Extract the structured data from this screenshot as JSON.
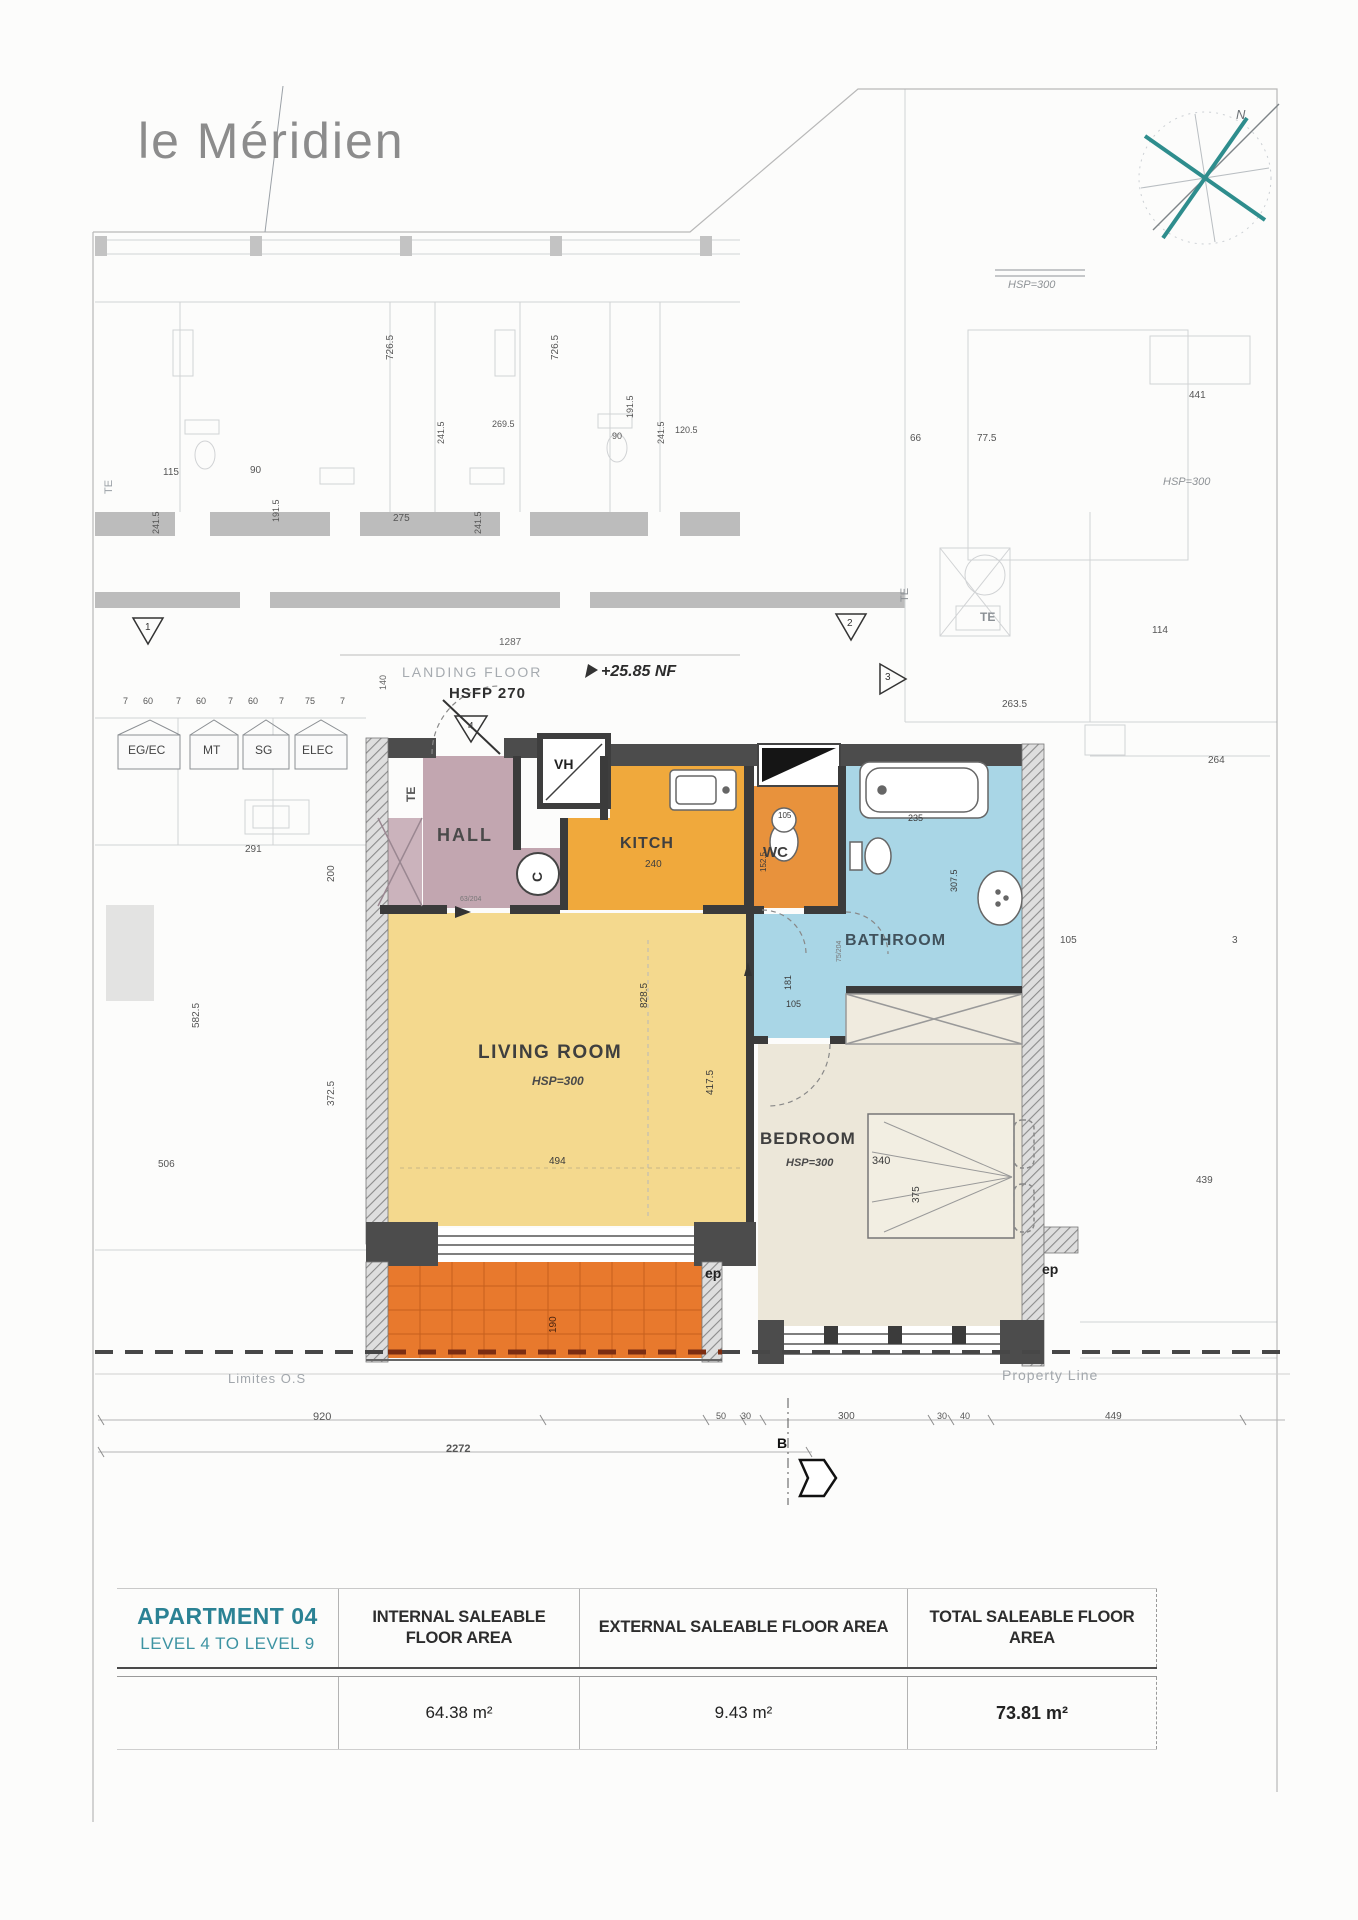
{
  "page": {
    "logo": "le Méridien"
  },
  "colors": {
    "accent_teal": "#2b8294",
    "hall": "#c2a6b0",
    "kitchen": "#f0a93c",
    "wc": "#e8923c",
    "bathroom": "#a9d6e6",
    "living_room": "#f4d98e",
    "bedroom": "#ece7d9",
    "terrace": "#e8792d",
    "wall_dark": "#4c4c4c",
    "dash_red": "#7c2d12"
  },
  "table": {
    "col1_title": "APARTMENT 04",
    "col1_subtitle": "LEVEL 4 TO LEVEL 9",
    "headers": [
      "INTERNAL SALEABLE FLOOR AREA",
      "EXTERNAL SALEABLE FLOOR AREA",
      "TOTAL SALEABLE FLOOR AREA"
    ],
    "values": [
      "64.38 m²",
      "9.43 m²",
      "73.81 m²"
    ]
  },
  "plan": {
    "labels": [
      {
        "text": "HALL",
        "x": 437,
        "y": 826,
        "size": 18,
        "weight": 700,
        "color": "#4a4a4a",
        "ls": 2,
        "name": "room-label-hall"
      },
      {
        "text": "KITCH",
        "x": 620,
        "y": 836,
        "size": 16,
        "weight": 700,
        "color": "#3f3f3f",
        "ls": 1,
        "name": "room-label-kitchen"
      },
      {
        "text": "240",
        "x": 645,
        "y": 860,
        "size": 10,
        "color": "#3f3f3f",
        "name": "dim-label"
      },
      {
        "text": "WC",
        "x": 763,
        "y": 845,
        "size": 15,
        "weight": 700,
        "color": "#3f3f3f",
        "name": "room-label-wc"
      },
      {
        "text": "BATHROOM",
        "x": 845,
        "y": 933,
        "size": 16,
        "weight": 700,
        "color": "#41525c",
        "ls": 1,
        "name": "room-label-bathroom"
      },
      {
        "text": "LIVING ROOM",
        "x": 478,
        "y": 1043,
        "size": 19,
        "weight": 700,
        "color": "#3f3f3f",
        "ls": 1.5,
        "name": "room-label-living-room"
      },
      {
        "text": "HSP=300",
        "x": 532,
        "y": 1075,
        "size": 12,
        "style": "italic",
        "weight": 600,
        "color": "#4a4a4a",
        "name": "ceiling-height-label"
      },
      {
        "text": "BEDROOM",
        "x": 760,
        "y": 1130,
        "size": 17,
        "weight": 700,
        "color": "#3f3f3f",
        "ls": 1,
        "name": "room-label-bedroom"
      },
      {
        "text": "HSP=300",
        "x": 786,
        "y": 1158,
        "size": 11,
        "style": "italic",
        "weight": 600,
        "color": "#4a4a4a",
        "name": "ceiling-height-label"
      },
      {
        "text": "VH",
        "x": 554,
        "y": 757,
        "size": 14,
        "weight": 700,
        "color": "#222",
        "name": "vh-shaft-label"
      },
      {
        "text": "C",
        "x": 530,
        "y": 882,
        "rot": -90,
        "size": 14,
        "weight": 600,
        "color": "#333",
        "name": "column-label"
      },
      {
        "text": "ep",
        "x": 705,
        "y": 1266,
        "size": 14,
        "weight": 700,
        "color": "#222",
        "name": "ep-label"
      },
      {
        "text": "ep",
        "x": 1042,
        "y": 1262,
        "size": 14,
        "weight": 700,
        "color": "#222",
        "name": "ep-label"
      },
      {
        "text": "828.5",
        "x": 640,
        "y": 1008,
        "rot": -90,
        "size": 10,
        "color": "#3a3a3a",
        "name": "dim-label"
      },
      {
        "text": "417.5",
        "x": 706,
        "y": 1095,
        "rot": -90,
        "size": 10,
        "color": "#3a3a3a",
        "name": "dim-label"
      },
      {
        "text": "494",
        "x": 549,
        "y": 1157,
        "size": 10,
        "color": "#3a3a3a",
        "name": "dim-label"
      },
      {
        "text": "152.5",
        "x": 760,
        "y": 872,
        "rot": -90,
        "size": 8,
        "color": "#3a3a3a",
        "name": "dim-label"
      },
      {
        "text": "105",
        "x": 778,
        "y": 812,
        "size": 8,
        "color": "#3a3a3a",
        "name": "dim-label"
      },
      {
        "text": "235",
        "x": 908,
        "y": 814,
        "size": 9,
        "color": "#3a3a3a",
        "name": "dim-label"
      },
      {
        "text": "307.5",
        "x": 950,
        "y": 892,
        "rot": -90,
        "size": 9,
        "color": "#3a3a3a",
        "name": "dim-label"
      },
      {
        "text": "181",
        "x": 784,
        "y": 990,
        "rot": -90,
        "size": 9,
        "color": "#3a3a3a",
        "name": "dim-label"
      },
      {
        "text": "105",
        "x": 786,
        "y": 1000,
        "size": 9,
        "color": "#3a3a3a",
        "name": "dim-label"
      },
      {
        "text": "340",
        "x": 872,
        "y": 1156,
        "size": 11,
        "color": "#3a3a3a",
        "name": "dim-label"
      },
      {
        "text": "375",
        "x": 912,
        "y": 1203,
        "rot": -90,
        "size": 10,
        "color": "#3a3a3a",
        "name": "dim-label"
      },
      {
        "text": "190",
        "x": 549,
        "y": 1333,
        "rot": -90,
        "size": 10,
        "color": "#4a2410",
        "name": "dim-label"
      },
      {
        "text": "63/204",
        "x": 460,
        "y": 896,
        "size": 7,
        "color": "#777",
        "name": "dim-label"
      },
      {
        "text": "75/204",
        "x": 836,
        "y": 962,
        "rot": -90,
        "size": 7,
        "color": "#777",
        "name": "dim-label"
      },
      {
        "text": "LANDING FLOOR",
        "x": 402,
        "y": 665,
        "size": 14,
        "color": "#a6abb0",
        "ls": 2,
        "name": "landing-floor-label"
      },
      {
        "text": "HSFP 270",
        "x": 449,
        "y": 686,
        "size": 15,
        "weight": 700,
        "color": "#2f2f2f",
        "ls": 1,
        "name": "hsfp-label"
      },
      {
        "text": "+25.85 NF",
        "x": 601,
        "y": 664,
        "size": 16,
        "weight": 700,
        "style": "italic",
        "color": "#2b2b2b",
        "name": "level-label"
      },
      {
        "text": "1287",
        "x": 499,
        "y": 638,
        "size": 10,
        "color": "#666",
        "name": "dim-label"
      },
      {
        "text": "140",
        "x": 379,
        "y": 690,
        "rot": -90,
        "size": 9,
        "color": "#666",
        "name": "dim-label"
      },
      {
        "text": "7",
        "x": 123,
        "y": 697,
        "size": 9,
        "color": "#555",
        "name": "dim-label"
      },
      {
        "text": "60",
        "x": 143,
        "y": 697,
        "size": 9,
        "color": "#555",
        "name": "dim-label"
      },
      {
        "text": "7",
        "x": 176,
        "y": 697,
        "size": 9,
        "color": "#555",
        "name": "dim-label"
      },
      {
        "text": "60",
        "x": 196,
        "y": 697,
        "size": 9,
        "color": "#555",
        "name": "dim-label"
      },
      {
        "text": "7",
        "x": 228,
        "y": 697,
        "size": 9,
        "color": "#555",
        "name": "dim-label"
      },
      {
        "text": "60",
        "x": 248,
        "y": 697,
        "size": 9,
        "color": "#555",
        "name": "dim-label"
      },
      {
        "text": "7",
        "x": 279,
        "y": 697,
        "size": 9,
        "color": "#555",
        "name": "dim-label"
      },
      {
        "text": "75",
        "x": 305,
        "y": 697,
        "size": 9,
        "color": "#555",
        "name": "dim-label"
      },
      {
        "text": "7",
        "x": 340,
        "y": 697,
        "size": 9,
        "color": "#555",
        "name": "dim-label"
      },
      {
        "text": "EG/EC",
        "x": 128,
        "y": 744,
        "size": 12,
        "color": "#444",
        "name": "utility-label-egec"
      },
      {
        "text": "MT",
        "x": 203,
        "y": 744,
        "size": 12,
        "color": "#444",
        "name": "utility-label-mt"
      },
      {
        "text": "SG",
        "x": 255,
        "y": 744,
        "size": 12,
        "color": "#444",
        "name": "utility-label-sg"
      },
      {
        "text": "ELEC",
        "x": 302,
        "y": 744,
        "size": 12,
        "color": "#444",
        "name": "utility-label-elec"
      },
      {
        "text": "1",
        "x": 145,
        "y": 623,
        "size": 10,
        "color": "#333",
        "name": "section-marker-1"
      },
      {
        "text": "2",
        "x": 847,
        "y": 619,
        "size": 10,
        "color": "#333",
        "name": "section-marker-2"
      },
      {
        "text": "3",
        "x": 885,
        "y": 673,
        "size": 10,
        "color": "#333",
        "name": "section-marker-3"
      },
      {
        "text": "4",
        "x": 468,
        "y": 722,
        "size": 10,
        "color": "#333",
        "name": "section-marker-4"
      },
      {
        "text": "B",
        "x": 777,
        "y": 1436,
        "size": 14,
        "weight": 700,
        "color": "#111",
        "name": "section-marker-b"
      },
      {
        "text": "TE",
        "x": 405,
        "y": 802,
        "rot": -90,
        "size": 12,
        "weight": 700,
        "color": "#555",
        "name": "te-label"
      },
      {
        "text": "TE",
        "x": 980,
        "y": 611,
        "size": 12,
        "weight": 700,
        "color": "#8a8f94",
        "name": "te-label"
      },
      {
        "text": "TE",
        "x": 900,
        "y": 602,
        "rot": -90,
        "size": 11,
        "color": "#8a8f94",
        "name": "te-label"
      },
      {
        "text": "TE",
        "x": 104,
        "y": 494,
        "rot": -90,
        "size": 11,
        "color": "#9aa0a6",
        "name": "te-label"
      },
      {
        "text": "726.5",
        "x": 386,
        "y": 360,
        "rot": -90,
        "size": 10,
        "name": "dim-label"
      },
      {
        "text": "726.5",
        "x": 551,
        "y": 360,
        "rot": -90,
        "size": 10,
        "name": "dim-label"
      },
      {
        "text": "115",
        "x": 163,
        "y": 468,
        "size": 10,
        "name": "dim-label"
      },
      {
        "text": "90",
        "x": 250,
        "y": 466,
        "size": 10,
        "name": "dim-label"
      },
      {
        "text": "191.5",
        "x": 272,
        "y": 522,
        "rot": -90,
        "size": 9,
        "name": "dim-label"
      },
      {
        "text": "241.5",
        "x": 152,
        "y": 534,
        "rot": -90,
        "size": 9,
        "name": "dim-label"
      },
      {
        "text": "241.5",
        "x": 474,
        "y": 534,
        "rot": -90,
        "size": 9,
        "name": "dim-label"
      },
      {
        "text": "275",
        "x": 393,
        "y": 514,
        "size": 10,
        "name": "dim-label"
      },
      {
        "text": "241.5",
        "x": 437,
        "y": 444,
        "rot": -90,
        "size": 9,
        "name": "dim-label"
      },
      {
        "text": "269.5",
        "x": 492,
        "y": 420,
        "size": 9,
        "name": "dim-label"
      },
      {
        "text": "191.5",
        "x": 626,
        "y": 418,
        "rot": -90,
        "size": 9,
        "name": "dim-label"
      },
      {
        "text": "90",
        "x": 612,
        "y": 432,
        "size": 9,
        "name": "dim-label"
      },
      {
        "text": "241.5",
        "x": 657,
        "y": 444,
        "rot": -90,
        "size": 9,
        "name": "dim-label"
      },
      {
        "text": "120.5",
        "x": 675,
        "y": 426,
        "size": 9,
        "name": "dim-label"
      },
      {
        "text": "66",
        "x": 910,
        "y": 434,
        "size": 10,
        "name": "dim-label"
      },
      {
        "text": "77.5",
        "x": 977,
        "y": 434,
        "size": 10,
        "name": "dim-label"
      },
      {
        "text": "441",
        "x": 1189,
        "y": 391,
        "size": 10,
        "name": "dim-label"
      },
      {
        "text": "HSP=300",
        "x": 1008,
        "y": 280,
        "size": 11,
        "style": "italic",
        "color": "#8e9296",
        "name": "ceiling-height-label"
      },
      {
        "text": "HSP=300",
        "x": 1163,
        "y": 477,
        "size": 11,
        "style": "italic",
        "color": "#8e9296",
        "name": "ceiling-height-label"
      },
      {
        "text": "114",
        "x": 1152,
        "y": 626,
        "size": 10,
        "name": "dim-label"
      },
      {
        "text": "263.5",
        "x": 1002,
        "y": 700,
        "size": 10,
        "name": "dim-label"
      },
      {
        "text": "264",
        "x": 1208,
        "y": 756,
        "size": 10,
        "name": "dim-label"
      },
      {
        "text": "105",
        "x": 1060,
        "y": 936,
        "size": 10,
        "name": "dim-label"
      },
      {
        "text": "3",
        "x": 1232,
        "y": 936,
        "size": 10,
        "name": "dim-label"
      },
      {
        "text": "439",
        "x": 1196,
        "y": 1176,
        "size": 10,
        "name": "dim-label"
      },
      {
        "text": "291",
        "x": 245,
        "y": 845,
        "size": 10,
        "name": "dim-label"
      },
      {
        "text": "200",
        "x": 327,
        "y": 882,
        "rot": -90,
        "size": 10,
        "name": "dim-label"
      },
      {
        "text": "582.5",
        "x": 192,
        "y": 1028,
        "rot": -90,
        "size": 10,
        "name": "dim-label"
      },
      {
        "text": "372.5",
        "x": 327,
        "y": 1106,
        "rot": -90,
        "size": 10,
        "name": "dim-label"
      },
      {
        "text": "506",
        "x": 158,
        "y": 1160,
        "size": 10,
        "name": "dim-label"
      },
      {
        "text": "920",
        "x": 313,
        "y": 1412,
        "size": 11,
        "color": "#555",
        "name": "dim-label"
      },
      {
        "text": "2272",
        "x": 446,
        "y": 1444,
        "size": 11,
        "weight": 700,
        "color": "#555",
        "name": "dim-label"
      },
      {
        "text": "50",
        "x": 716,
        "y": 1412,
        "size": 9,
        "color": "#555",
        "name": "dim-label"
      },
      {
        "text": "30",
        "x": 741,
        "y": 1412,
        "size": 9,
        "color": "#555",
        "name": "dim-label"
      },
      {
        "text": "300",
        "x": 838,
        "y": 1412,
        "size": 10,
        "color": "#555",
        "name": "dim-label"
      },
      {
        "text": "30",
        "x": 937,
        "y": 1412,
        "size": 9,
        "color": "#555",
        "name": "dim-label"
      },
      {
        "text": "40",
        "x": 960,
        "y": 1412,
        "size": 9,
        "color": "#555",
        "name": "dim-label"
      },
      {
        "text": "449",
        "x": 1105,
        "y": 1412,
        "size": 10,
        "color": "#555",
        "name": "dim-label"
      },
      {
        "text": "Limites O.S",
        "x": 228,
        "y": 1372,
        "size": 13,
        "color": "#a2a7ac",
        "ls": 1,
        "name": "limites-os-label"
      },
      {
        "text": "Property Line",
        "x": 1002,
        "y": 1368,
        "size": 14,
        "color": "#a2a7ac",
        "ls": 1,
        "name": "property-line-label"
      },
      {
        "text": "N",
        "x": 1236,
        "y": 108,
        "size": 13,
        "style": "italic",
        "color": "#6b7075",
        "name": "compass-n-label"
      }
    ]
  }
}
